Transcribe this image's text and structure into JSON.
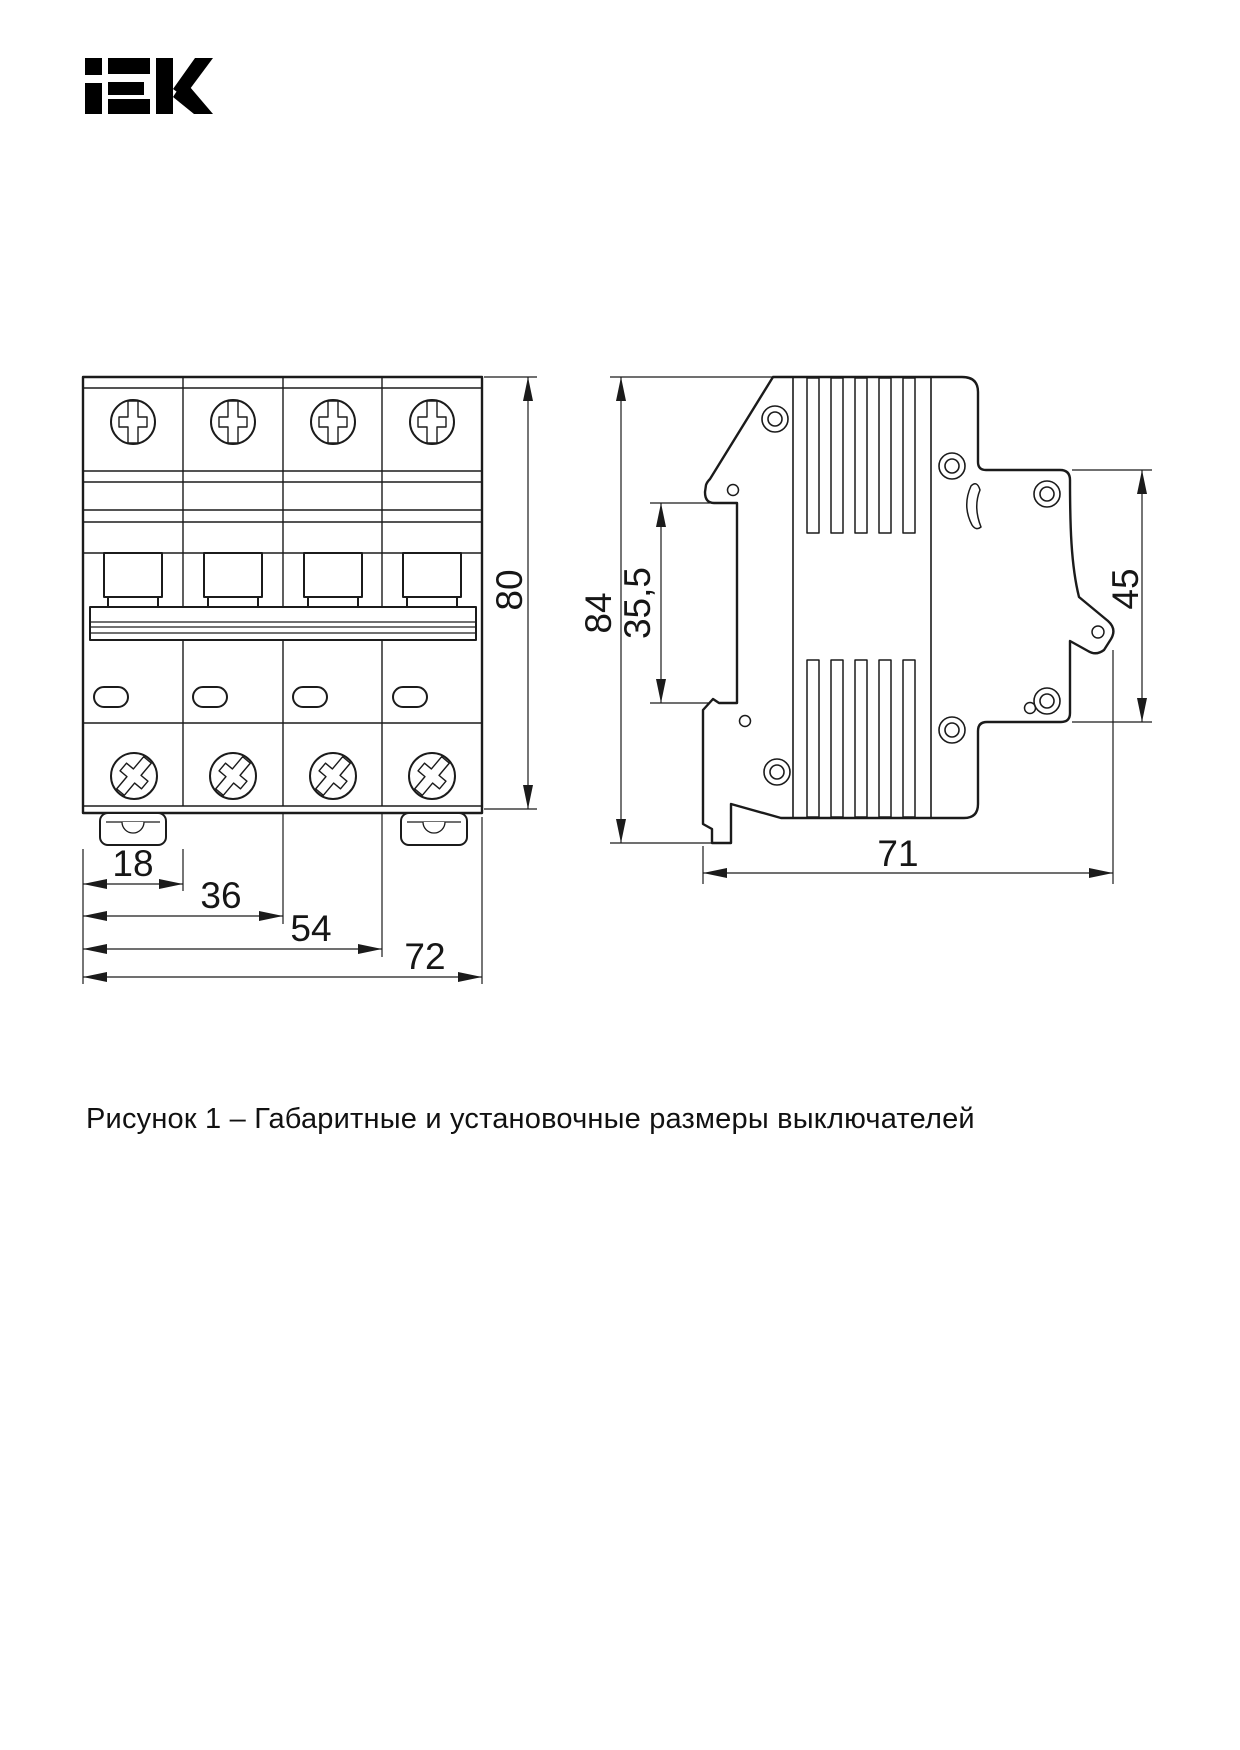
{
  "logo": {
    "text": "iEK",
    "color": "#000000"
  },
  "caption": "Рисунок 1 – Габаритные и установочные размеры выключателей",
  "figure": {
    "line_color": "#1b1b1b",
    "front_view": {
      "description": "front view of 4-pole modular circuit breaker",
      "width_dims": [
        "18",
        "36",
        "54",
        "72"
      ],
      "height_dim": "80",
      "modules": "4"
    },
    "side_view": {
      "description": "side view of modular circuit breaker",
      "height_dim": "84",
      "din_recess_dim": "35,5",
      "front_panel_dim": "45",
      "depth_dim": "71"
    }
  }
}
